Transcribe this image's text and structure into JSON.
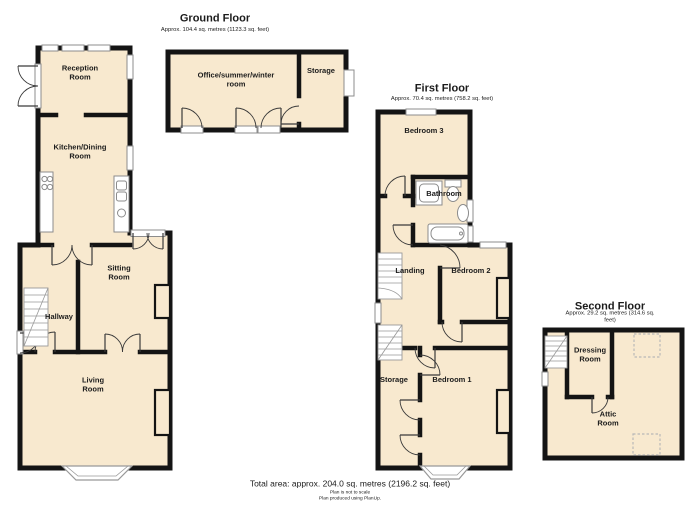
{
  "colors": {
    "room_fill": "#F8E9CF",
    "wall": "#141414",
    "fixture_stroke": "#8c8c8c",
    "dashed_outline": "#b8b8b8",
    "background": "#ffffff"
  },
  "floors": [
    {
      "title": "Ground Floor",
      "area": "Approx. 104.4 sq. metres (1123.3 sq. feet)",
      "rooms": [
        {
          "label": "Reception\nRoom"
        },
        {
          "label": "Kitchen/Dining\nRoom"
        },
        {
          "label": "Sitting\nRoom"
        },
        {
          "label": "Hallway"
        },
        {
          "label": "Living\nRoom"
        },
        {
          "label": "Office/summer/winter\nroom"
        },
        {
          "label": "Storage"
        }
      ]
    },
    {
      "title": "First Floor",
      "area": "Approx. 70.4 sq. metres (758.2 sq. feet)",
      "rooms": [
        {
          "label": "Bedroom 3"
        },
        {
          "label": "Bathroom"
        },
        {
          "label": "Landing"
        },
        {
          "label": "Bedroom 2"
        },
        {
          "label": "Storage"
        },
        {
          "label": "Bedroom 1"
        }
      ]
    },
    {
      "title": "Second Floor",
      "area": "Approx. 29.2 sq. metres (314.6 sq. feet)",
      "rooms": [
        {
          "label": "Dressing\nRoom"
        },
        {
          "label": "Attic\nRoom"
        }
      ]
    }
  ],
  "footer": {
    "total_area": "Total area: approx. 204.0 sq. metres (2196.2 sq. feet)",
    "disclaimer": "Plan is not to scale",
    "credit": "Plan produced using PlanUp."
  }
}
